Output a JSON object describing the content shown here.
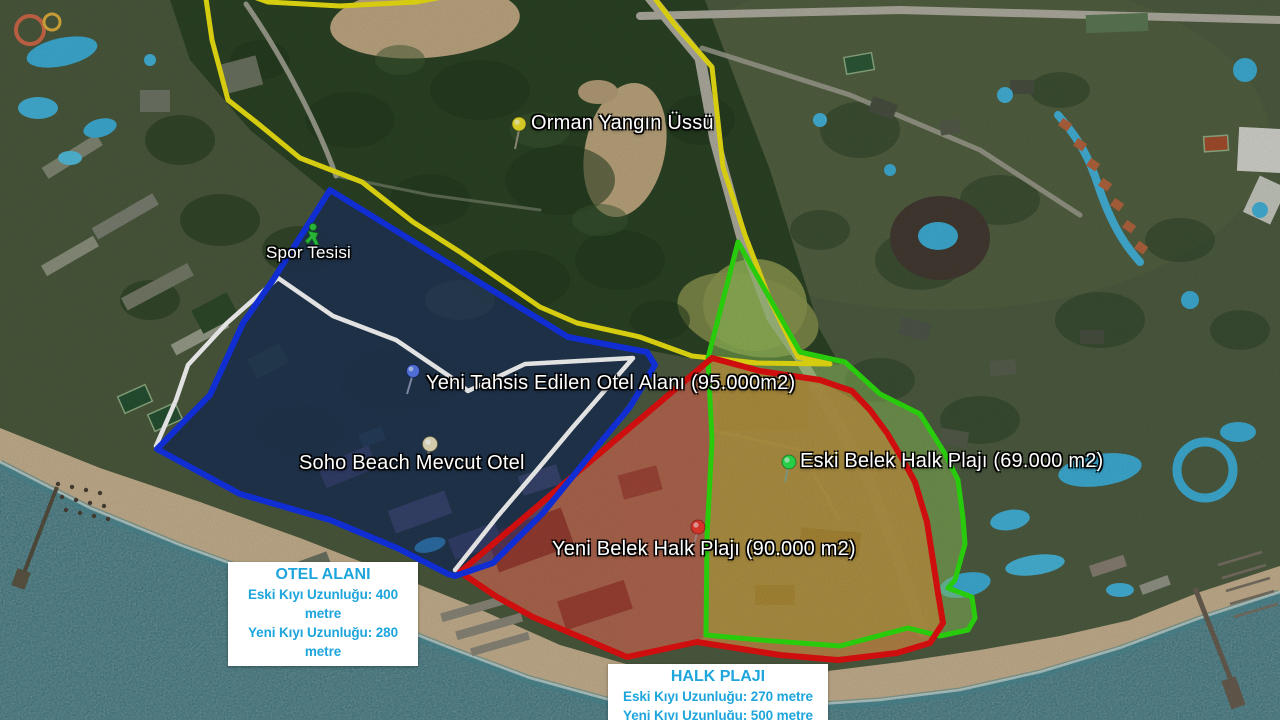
{
  "map_type": "satellite-annotated",
  "labels": {
    "orman": {
      "text": "Orman Yangın Üssü",
      "pin": "yellow-pushpin",
      "pin_color": "#f0e42c"
    },
    "spor": {
      "text": "Spor Tesisi",
      "pin": "green-person-icon",
      "pin_color": "#2ecb3e"
    },
    "yeni_tahsis": {
      "text": "Yeni Tahsis Edilen Otel Alanı (95.000m2)",
      "pin": "blue-pushpin",
      "pin_color": "#5a7df0"
    },
    "soho": {
      "text": "Soho Beach Mevcut Otel",
      "pin": "cream-pushpin",
      "pin_color": "#eee6c2"
    },
    "eski_belek": {
      "text": "Eski Belek Halk Plajı (69.000 m2)",
      "pin": "green-pushpin",
      "pin_color": "#2ce84f"
    },
    "yeni_belek": {
      "text": "Yeni Belek Halk Plajı (90.000 m2)",
      "pin": "red-pushpin",
      "pin_color": "#ef3b2f"
    }
  },
  "info_boxes": {
    "otel": {
      "title": "OTEL ALANI",
      "line1": "Eski Kıyı Uzunluğu: 400 metre",
      "line2": "Yeni Kıyı Uzunluğu: 280 metre"
    },
    "halk": {
      "title": "HALK PLAJI",
      "line1": "Eski Kıyı Uzunluğu: 270 metre",
      "line2": "Yeni Kıyı Uzunluğu: 500 metre"
    }
  },
  "regions": {
    "forest": {
      "name": "orman-alani",
      "outline": "#f2e713"
    },
    "otel_new": {
      "name": "yeni-otel-alani",
      "outline": "#1334ee",
      "fill": "rgba(30,50,125,0.5)"
    },
    "otel_old": {
      "name": "eski-otel-siniri",
      "outline": "#ffffff"
    },
    "halk_yeni": {
      "name": "yeni-halk-plaji",
      "outline": "#ea1010",
      "fill": "rgba(190,65,50,0.48)"
    },
    "halk_eski": {
      "name": "eski-halk-plaji",
      "outline": "#2ee60e",
      "fill": "rgba(150,205,95,0.5)"
    }
  },
  "colors": {
    "info_text": "#1ea5dc",
    "sea": "#266069",
    "sand": "#c9b391"
  }
}
